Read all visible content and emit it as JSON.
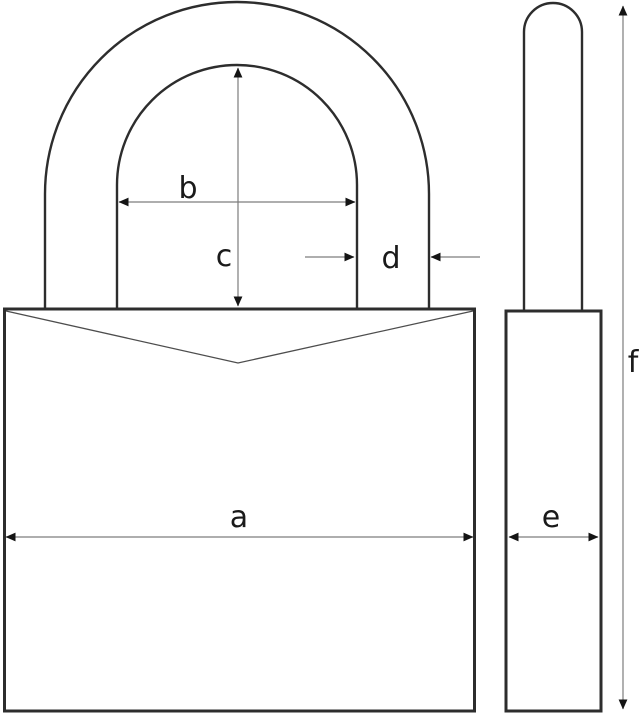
{
  "diagram": {
    "labels": {
      "a": "a",
      "b": "b",
      "c": "c",
      "d": "d",
      "e": "e",
      "f": "f"
    },
    "colors": {
      "outline": "#2d2d2d",
      "notch": "#4d4d4d",
      "dimension_line": "#7d7d7d",
      "arrowhead": "#141414",
      "label_text": "#1a1a1a",
      "background": "#ffffff"
    }
  }
}
